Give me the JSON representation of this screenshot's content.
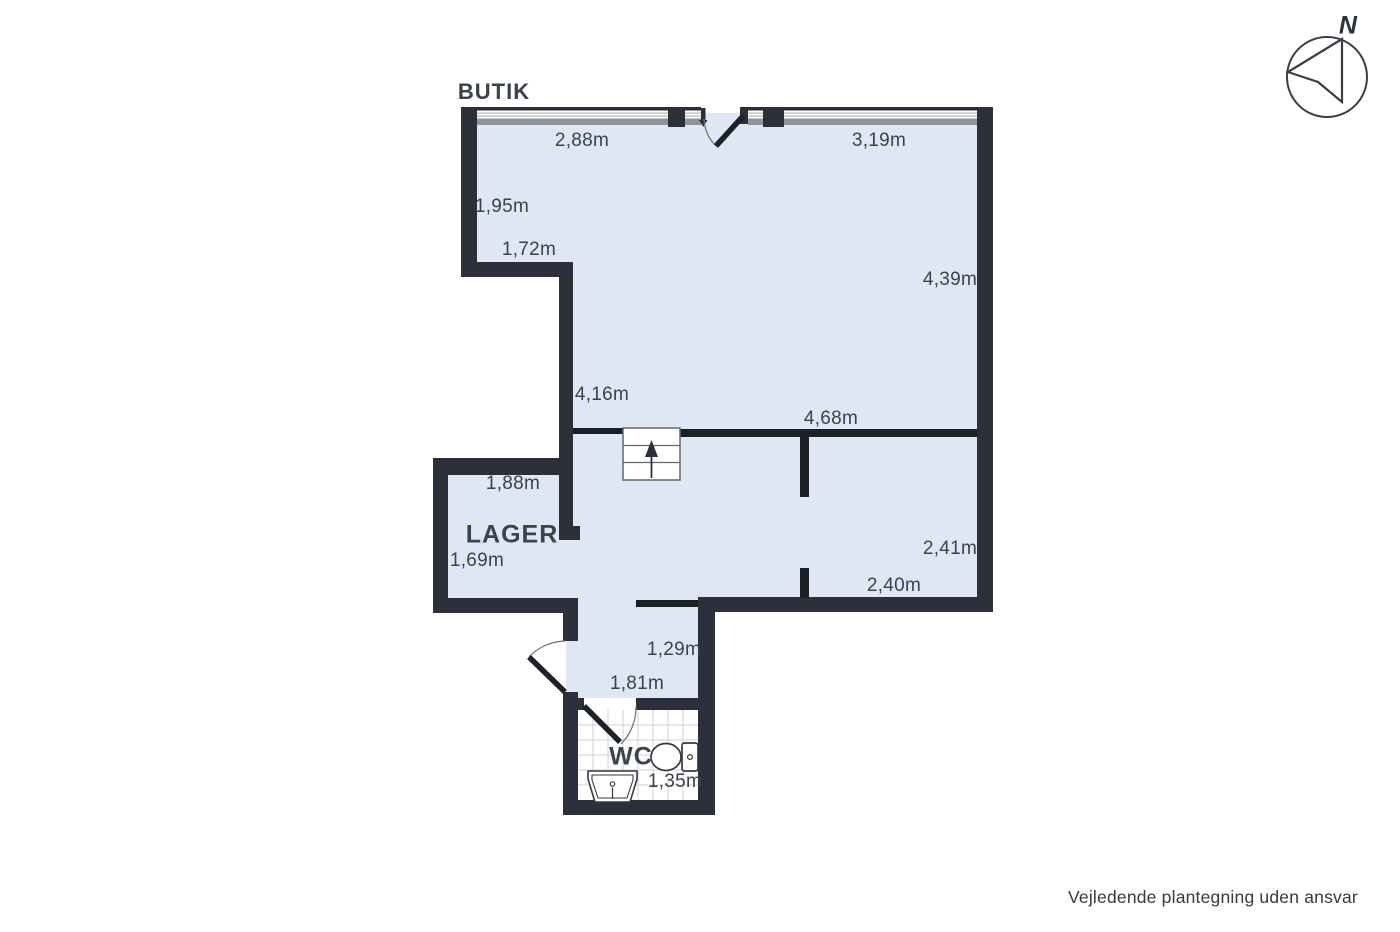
{
  "plan": {
    "rooms": [
      {
        "name": "BUTIK"
      },
      {
        "name": "LAGER"
      },
      {
        "name": "WC"
      }
    ],
    "measurements": [
      {
        "value": "2,88m"
      },
      {
        "value": "3,19m"
      },
      {
        "value": "1,95m"
      },
      {
        "value": "1,72m"
      },
      {
        "value": "4,39m"
      },
      {
        "value": "4,16m"
      },
      {
        "value": "4,68m"
      },
      {
        "value": "1,88m"
      },
      {
        "value": "1,69m"
      },
      {
        "value": "2,41m"
      },
      {
        "value": "2,40m"
      },
      {
        "value": "1,29m"
      },
      {
        "value": "1,81m"
      },
      {
        "value": "1,35m"
      }
    ],
    "compass": {
      "label": "N"
    },
    "disclaimer": "Vejledende plantegning uden ansvar",
    "symbols": {
      "compass": "north-arrow-compass",
      "stairs": "staircase-up-arrow",
      "toilet": "toilet-icon",
      "sink": "sink-icon",
      "entrance_door": "door-swing-arc",
      "shop_door": "door-swing-arc",
      "wc_door": "door-swing-arc",
      "windows": "window-band"
    },
    "colors": {
      "wall": "#2b303a",
      "interior_wall": "#1b1f26",
      "floor": "#dee7f3",
      "window_gray": "#8f939a",
      "text": "#3c424a"
    }
  }
}
